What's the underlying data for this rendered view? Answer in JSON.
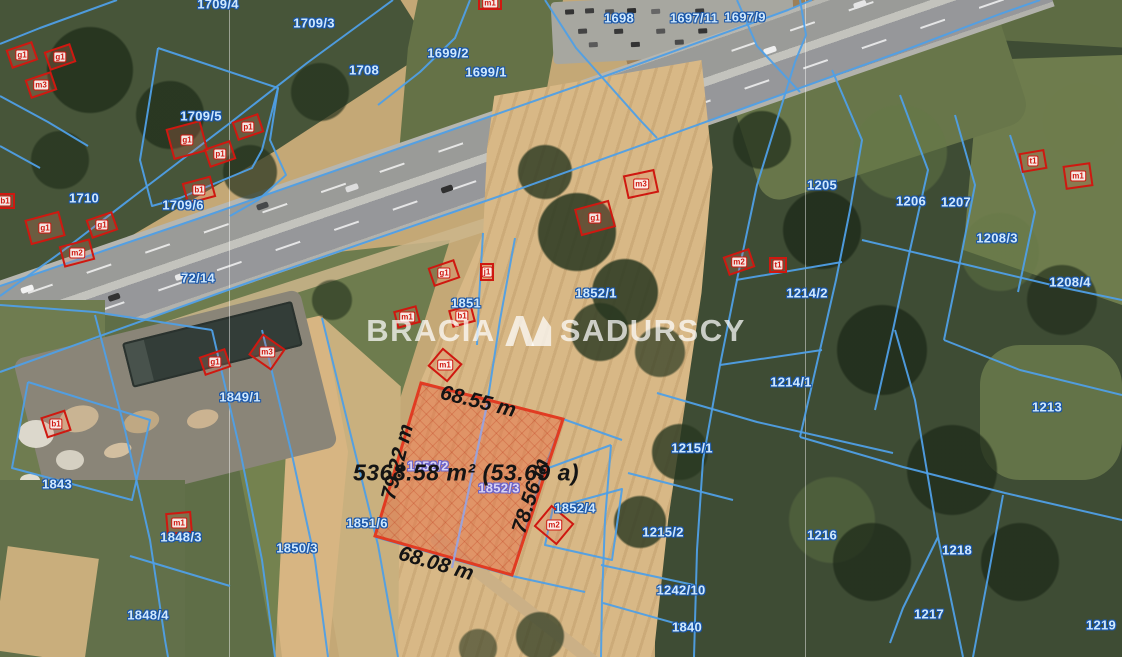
{
  "watermark": {
    "left": "BRACIA",
    "right": "SADURSCY"
  },
  "highlight": {
    "area": "5368.58 m² (53.69 a)",
    "top": "68.55 m",
    "left_side": "79.22 m",
    "right_side": "78.56 m",
    "bottom": "68.08 m"
  },
  "parcels": [
    {
      "t": "1709/4",
      "x": 218,
      "y": 4
    },
    {
      "t": "1709/3",
      "x": 314,
      "y": 23
    },
    {
      "t": "1698",
      "x": 619,
      "y": 18
    },
    {
      "t": "1697/11",
      "x": 694,
      "y": 18
    },
    {
      "t": "1697/9",
      "x": 745,
      "y": 17
    },
    {
      "t": "1699/2",
      "x": 448,
      "y": 53
    },
    {
      "t": "1699/1",
      "x": 486,
      "y": 72
    },
    {
      "t": "1708",
      "x": 364,
      "y": 70
    },
    {
      "t": "1709/5",
      "x": 201,
      "y": 116
    },
    {
      "t": "1710",
      "x": 84,
      "y": 198
    },
    {
      "t": "1709/6",
      "x": 183,
      "y": 205
    },
    {
      "t": "72/14",
      "x": 198,
      "y": 278
    },
    {
      "t": "1205",
      "x": 822,
      "y": 185
    },
    {
      "t": "1206",
      "x": 911,
      "y": 201
    },
    {
      "t": "1207",
      "x": 956,
      "y": 202
    },
    {
      "t": "1208/3",
      "x": 997,
      "y": 238
    },
    {
      "t": "1208/4",
      "x": 1070,
      "y": 282
    },
    {
      "t": "1214/2",
      "x": 807,
      "y": 293
    },
    {
      "t": "1852/1",
      "x": 596,
      "y": 293
    },
    {
      "t": "1851",
      "x": 466,
      "y": 303
    },
    {
      "t": "1214/1",
      "x": 791,
      "y": 382
    },
    {
      "t": "1213",
      "x": 1047,
      "y": 407
    },
    {
      "t": "1215/1",
      "x": 692,
      "y": 448
    },
    {
      "t": "1849/1",
      "x": 240,
      "y": 397
    },
    {
      "t": "1843",
      "x": 57,
      "y": 484
    },
    {
      "t": "1848/3",
      "x": 181,
      "y": 537
    },
    {
      "t": "1850/3",
      "x": 297,
      "y": 548
    },
    {
      "t": "1851/6",
      "x": 367,
      "y": 523
    },
    {
      "t": "1852/2",
      "x": 428,
      "y": 466,
      "v": "lavender"
    },
    {
      "t": "1852/3",
      "x": 499,
      "y": 488,
      "v": "lavender"
    },
    {
      "t": "1852/4",
      "x": 575,
      "y": 508
    },
    {
      "t": "1215/2",
      "x": 663,
      "y": 532
    },
    {
      "t": "1216",
      "x": 822,
      "y": 535
    },
    {
      "t": "1242/10",
      "x": 681,
      "y": 590
    },
    {
      "t": "1840",
      "x": 687,
      "y": 627
    },
    {
      "t": "1848/4",
      "x": 148,
      "y": 615
    },
    {
      "t": "1217",
      "x": 929,
      "y": 614
    },
    {
      "t": "1218",
      "x": 957,
      "y": 550
    },
    {
      "t": "1219",
      "x": 1101,
      "y": 625
    }
  ],
  "buildings": [
    {
      "t": "g1",
      "x": 22,
      "y": 55
    },
    {
      "t": "g1",
      "x": 60,
      "y": 57
    },
    {
      "t": "m3",
      "x": 41,
      "y": 85
    },
    {
      "t": "g1",
      "x": 187,
      "y": 140,
      "w": 34,
      "h": 30,
      "r": -15
    },
    {
      "t": "p1",
      "x": 248,
      "y": 127
    },
    {
      "t": "p1",
      "x": 220,
      "y": 154
    },
    {
      "t": "b1",
      "x": 199,
      "y": 190,
      "w": 28,
      "h": 20,
      "r": -15
    },
    {
      "t": "b1",
      "x": 5,
      "y": 201,
      "w": 18,
      "h": 14,
      "r": 0
    },
    {
      "t": "g1",
      "x": 45,
      "y": 228,
      "w": 34,
      "h": 24,
      "r": -15
    },
    {
      "t": "g1",
      "x": 102,
      "y": 225
    },
    {
      "t": "m2",
      "x": 77,
      "y": 253,
      "w": 30,
      "h": 20,
      "r": -15
    },
    {
      "t": "m1",
      "x": 490,
      "y": 3,
      "w": 22,
      "h": 12,
      "r": 0
    },
    {
      "t": "m3",
      "x": 641,
      "y": 184,
      "w": 30,
      "h": 22,
      "r": -12
    },
    {
      "t": "g1",
      "x": 595,
      "y": 218,
      "w": 34,
      "h": 26,
      "r": -15
    },
    {
      "t": "m2",
      "x": 739,
      "y": 262
    },
    {
      "t": "t1",
      "x": 778,
      "y": 265,
      "w": 16,
      "h": 14,
      "r": 0
    },
    {
      "t": "t1",
      "x": 1033,
      "y": 161,
      "w": 24,
      "h": 18,
      "r": -10
    },
    {
      "t": "m1",
      "x": 1078,
      "y": 176,
      "w": 26,
      "h": 22,
      "r": -8
    },
    {
      "t": "g1",
      "x": 444,
      "y": 273
    },
    {
      "t": "j1",
      "x": 487,
      "y": 272,
      "w": 12,
      "h": 16,
      "r": 0
    },
    {
      "t": "b1",
      "x": 462,
      "y": 316,
      "w": 22,
      "h": 16,
      "r": -15
    },
    {
      "t": "m1",
      "x": 407,
      "y": 317,
      "w": 22,
      "h": 16,
      "r": -15
    },
    {
      "t": "g1",
      "x": 215,
      "y": 362
    },
    {
      "t": "m3",
      "x": 267,
      "y": 352,
      "w": 26,
      "h": 24,
      "r": 35
    },
    {
      "t": "m1",
      "x": 445,
      "y": 365,
      "w": 24,
      "h": 22,
      "r": 40
    },
    {
      "t": "b1",
      "x": 56,
      "y": 424,
      "w": 24,
      "h": 20,
      "r": -18
    },
    {
      "t": "m1",
      "x": 179,
      "y": 523,
      "w": 24,
      "h": 20,
      "r": -5
    },
    {
      "t": "m2",
      "x": 554,
      "y": 525,
      "w": 28,
      "h": 26,
      "r": 40
    }
  ],
  "colors": {
    "boundary": "#4f9fe6",
    "parcel_text": "#cfe8fd",
    "lavender_text": "#d9d3f4",
    "building": "#cf1810",
    "highlight_stroke": "#e23b22",
    "highlight_fill": "rgba(232,112,72,0.5)",
    "watermark": "rgba(255,255,255,0.72)"
  }
}
